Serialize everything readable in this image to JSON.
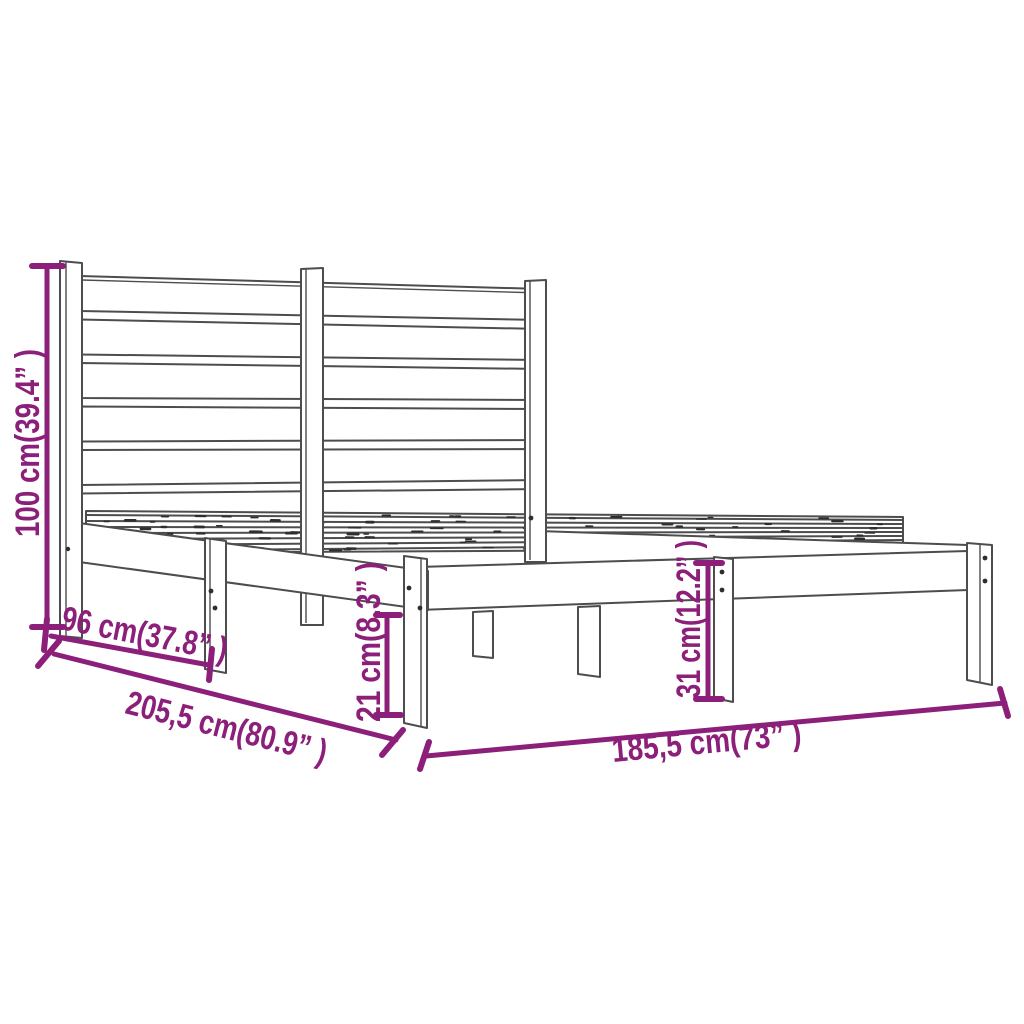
{
  "diagram": {
    "title": "Bed frame dimension diagram",
    "subject": "wooden slatted bed frame with headboard",
    "background": "#FFFFFF",
    "line_color": "#4D4D4D",
    "dimension_color": "#8B1F7A",
    "labels": {
      "height": "100 cm(39.4” )",
      "side_span": "96 cm(37.8” )",
      "total_length": "205,5 cm(80.9” )",
      "under_clearance": "21 cm(8.3” )",
      "base_height": "31 cm(12.2” )",
      "width": "185,5 cm(73” )"
    }
  }
}
